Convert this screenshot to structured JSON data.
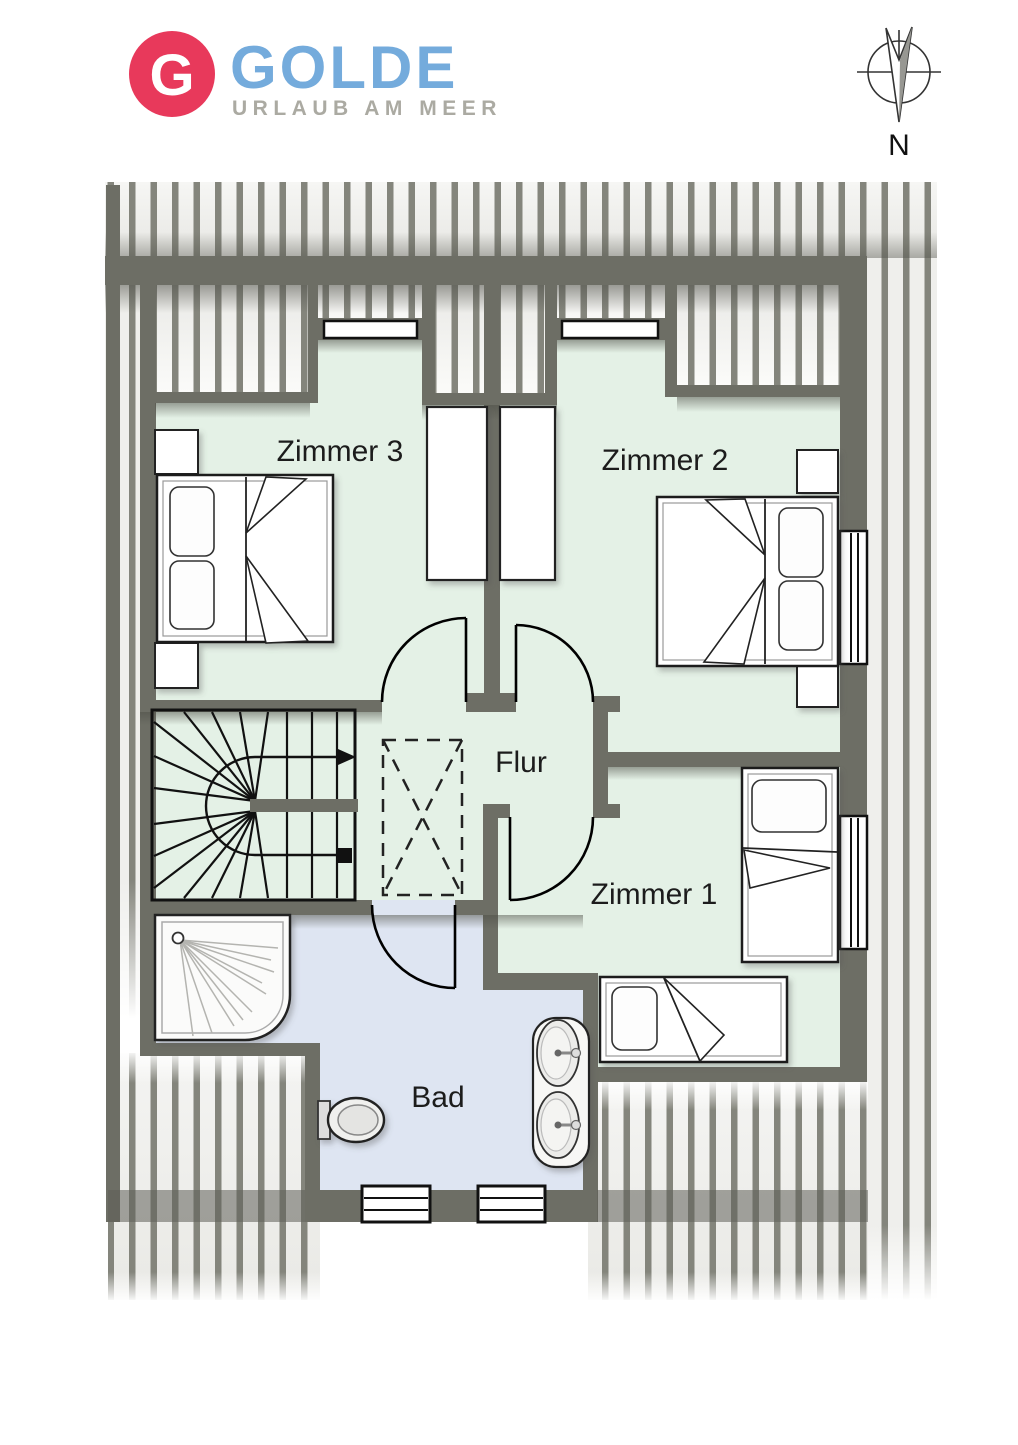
{
  "page": {
    "width": 1018,
    "height": 1440,
    "background": "#ffffff",
    "type": "floor-plan-upper-storey"
  },
  "logo": {
    "monogram": "G",
    "brand": "GOLDE",
    "tagline": "URLAUB AM MEER",
    "monogram_bg": "#e8395b",
    "brand_color": "#74abdc",
    "tagline_color": "#abaaa2"
  },
  "compass": {
    "label": "N"
  },
  "rooms": {
    "zimmer3": {
      "label": "Zimmer 3"
    },
    "zimmer2": {
      "label": "Zimmer 2"
    },
    "zimmer1": {
      "label": "Zimmer 1"
    },
    "flur": {
      "label": "Flur"
    },
    "bad": {
      "label": "Bad"
    }
  },
  "colors": {
    "wall": "#6d6e65",
    "room_floor": "#e4f1e6",
    "bath_floor": "#dee5f2",
    "roof_stripe": "#84857c",
    "roof_background": "#efefec",
    "line": "#111111"
  },
  "furniture": {
    "zimmer3": [
      "double-bed",
      "nightstand",
      "nightstand",
      "wardrobe",
      "dormer-window"
    ],
    "zimmer2": [
      "double-bed",
      "nightstand",
      "nightstand",
      "wardrobe",
      "dormer-window",
      "side-window"
    ],
    "zimmer1": [
      "single-bed",
      "single-bed",
      "side-window"
    ],
    "flur": [
      "winder-staircase",
      "stair-direction-arrow",
      "dashed-closet"
    ],
    "bad": [
      "corner-shower",
      "toilet",
      "double-washbasin",
      "window",
      "window"
    ]
  }
}
